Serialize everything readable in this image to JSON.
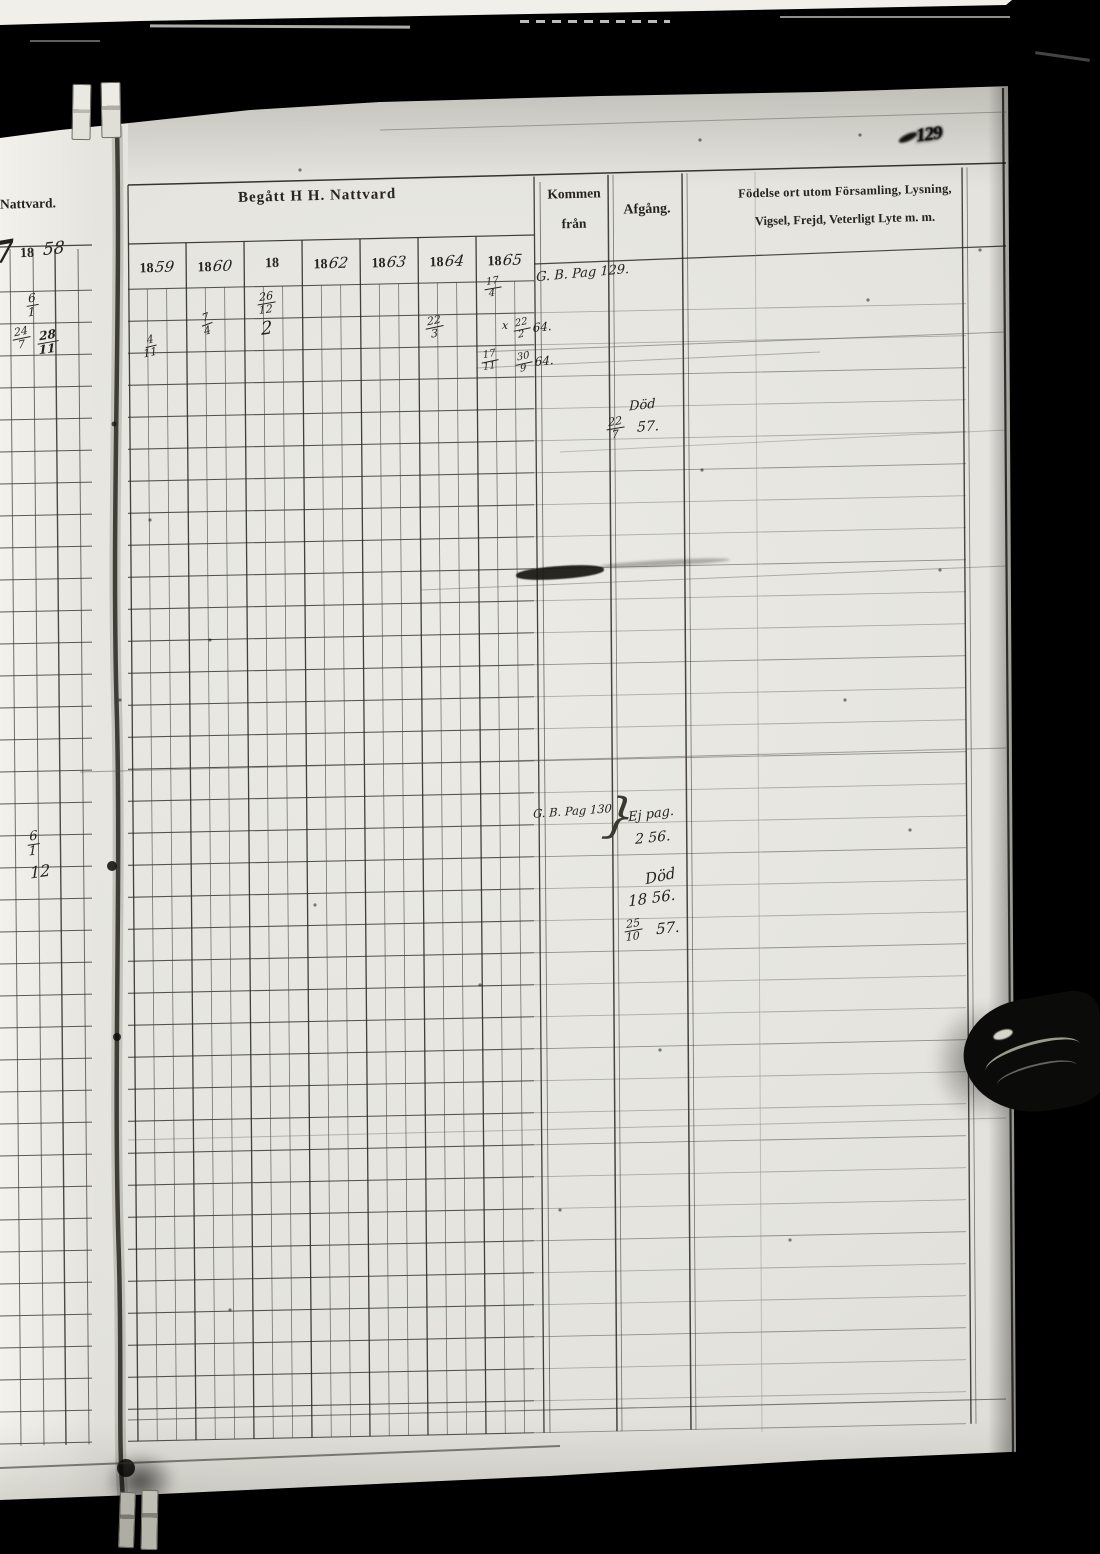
{
  "page_number": "129",
  "left_fragment": {
    "header": "Nattvard.",
    "year_printed": "18",
    "year_script": "58",
    "stray_numeral": "7"
  },
  "table": {
    "title": "Begått H  H. Nattvard",
    "kommen_line1": "Kommen",
    "kommen_line2": "från",
    "afgang": "Afgång.",
    "fodelse_line1": "Födelse ort utom Församling, Lysning,",
    "fodelse_line2": "Vigsel, Frejd, Veterligt Lyte m. m.",
    "year_columns": [
      {
        "printed": "18",
        "script": "59"
      },
      {
        "printed": "18",
        "script": "60"
      },
      {
        "printed": "18",
        "script": ""
      },
      {
        "printed": "18",
        "script": "62"
      },
      {
        "printed": "18",
        "script": "63"
      },
      {
        "printed": "18",
        "script": "64"
      },
      {
        "printed": "18",
        "script": "65"
      }
    ]
  },
  "handwriting": [
    {
      "kind": "frac",
      "num": "6",
      "den": "1",
      "x": 26,
      "y": 292,
      "s": 12,
      "r": -4
    },
    {
      "kind": "frac",
      "num": "24",
      "den": "7",
      "x": 12,
      "y": 326,
      "s": 11,
      "r": -6
    },
    {
      "kind": "frac",
      "num": "28",
      "den": "11",
      "x": 37,
      "y": 329,
      "s": 12,
      "r": -4,
      "b": true
    },
    {
      "kind": "frac",
      "num": "6",
      "den": "1",
      "x": 27,
      "y": 830,
      "s": 13,
      "r": -3
    },
    {
      "kind": "text",
      "text": "12",
      "x": 30,
      "y": 864,
      "s": 16,
      "r": -8
    },
    {
      "kind": "text",
      "text": "7",
      "x": -6,
      "y": 238,
      "s": 30,
      "r": -10,
      "b": true
    },
    {
      "kind": "frac",
      "num": "17",
      "den": "4",
      "x": 484,
      "y": 277,
      "s": 10,
      "r": -4
    },
    {
      "kind": "frac",
      "num": "26",
      "den": "12",
      "x": 257,
      "y": 291,
      "s": 11,
      "r": -4
    },
    {
      "kind": "text",
      "text": "2",
      "x": 261,
      "y": 320,
      "s": 18,
      "r": -8
    },
    {
      "kind": "frac",
      "num": "7",
      "den": "4",
      "x": 201,
      "y": 312,
      "s": 11,
      "r": -14
    },
    {
      "kind": "frac",
      "num": "4",
      "den": "11",
      "x": 143,
      "y": 334,
      "s": 11,
      "r": -8
    },
    {
      "kind": "frac",
      "num": "22",
      "den": "3",
      "x": 425,
      "y": 315,
      "s": 11,
      "r": -6
    },
    {
      "kind": "text",
      "text": "x",
      "x": 502,
      "y": 320,
      "s": 11,
      "r": 0
    },
    {
      "kind": "frac",
      "num": "17",
      "den": "11",
      "x": 481,
      "y": 350,
      "s": 10,
      "r": -6
    },
    {
      "kind": "frac",
      "num": "22",
      "den": "2",
      "suffix": "64.",
      "x": 513,
      "y": 317,
      "s": 10,
      "r": -6
    },
    {
      "kind": "frac",
      "num": "30",
      "den": "9",
      "suffix": "64.",
      "x": 515,
      "y": 351,
      "s": 10,
      "r": -6
    },
    {
      "kind": "text",
      "text": "G. B. Pag 129.",
      "x": 536,
      "y": 267,
      "s": 13,
      "r": -5
    },
    {
      "kind": "text",
      "text": "Död",
      "x": 629,
      "y": 399,
      "s": 13,
      "r": -6
    },
    {
      "kind": "frac",
      "num": "22",
      "den": "7",
      "x": 606,
      "y": 416,
      "s": 11,
      "r": -4
    },
    {
      "kind": "text",
      "text": "57.",
      "x": 637,
      "y": 420,
      "s": 14,
      "r": -4
    },
    {
      "kind": "text",
      "text": "G. B. Pag 130",
      "x": 533,
      "y": 806,
      "s": 11.5,
      "r": -4
    },
    {
      "kind": "text",
      "text": "}",
      "x": 604,
      "y": 792,
      "s": 48,
      "r": 4,
      "lt": true
    },
    {
      "kind": "text",
      "text": "Ej pag.",
      "x": 628,
      "y": 808,
      "s": 13,
      "r": -8
    },
    {
      "kind": "text",
      "text": "2 56.",
      "x": 635,
      "y": 831,
      "s": 14,
      "r": -6
    },
    {
      "kind": "text",
      "text": "Död",
      "x": 645,
      "y": 869,
      "s": 15,
      "r": -12
    },
    {
      "kind": "text",
      "text": "18 56.",
      "x": 628,
      "y": 891,
      "s": 15,
      "r": -8
    },
    {
      "kind": "frac",
      "num": "25",
      "den": "10",
      "x": 624,
      "y": 918,
      "s": 11,
      "r": -4
    },
    {
      "kind": "text",
      "text": "57.",
      "x": 656,
      "y": 921,
      "s": 15,
      "r": -6
    }
  ]
}
